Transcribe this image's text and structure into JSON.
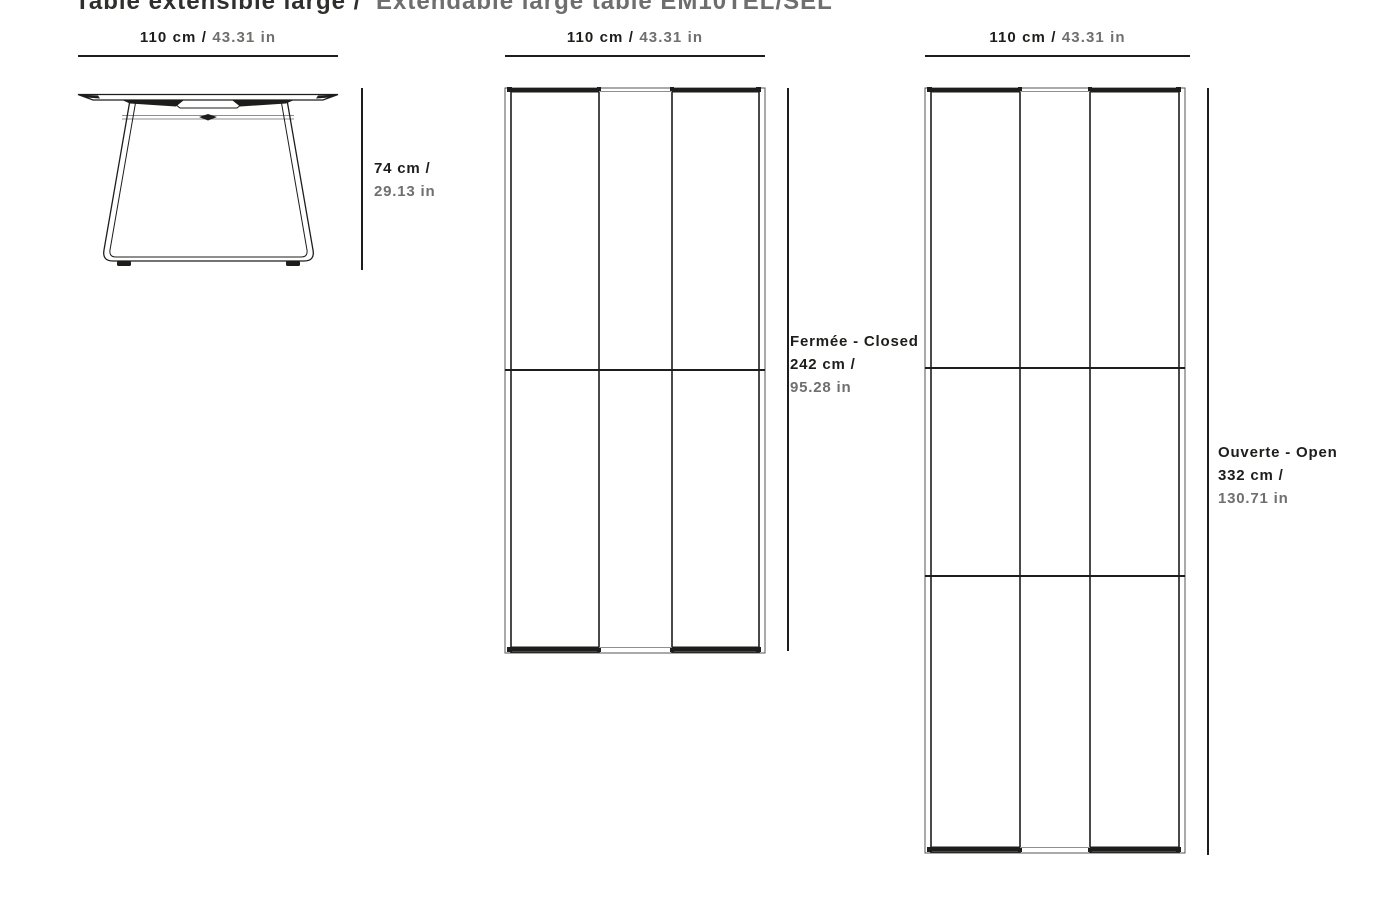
{
  "title": {
    "part_fr": "Table extensible large /",
    "part_en": "Extendable large table EM10TEL/SEL"
  },
  "colors": {
    "ink": "#1d1d1b",
    "muted": "#6f6f6e"
  },
  "views": {
    "side": {
      "label": "side elevation view",
      "width": {
        "cm": "110 cm /",
        "in": "43.31 in"
      },
      "height": {
        "cm": "74 cm /",
        "in": "29.13 in"
      }
    },
    "closed": {
      "label": "top view closed",
      "width": {
        "cm": "110 cm /",
        "in": "43.31 in"
      },
      "state": "Fermée - Closed",
      "length": {
        "cm": "242 cm /",
        "in": "95.28 in"
      }
    },
    "open": {
      "label": "top view open",
      "width": {
        "cm": "110 cm /",
        "in": "43.31 in"
      },
      "state": "Ouverte - Open",
      "length": {
        "cm": "332 cm /",
        "in": "130.71 in"
      }
    }
  }
}
